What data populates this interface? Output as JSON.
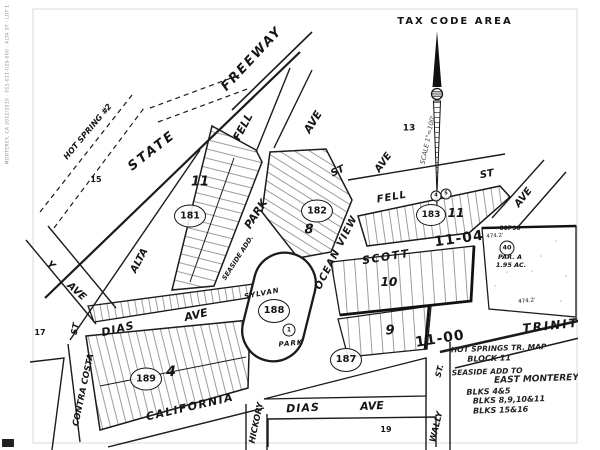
{
  "title": {
    "tax_code_area": "TAX CODE AREA",
    "scale_note": "SCALE 1\"=100'",
    "microprint": "MONTEREY, CA 2012/2019 · 011-021-025-000 · ALTA ST · LOT 1 · SHEET 1 OF 1"
  },
  "streets": {
    "state": "STATE",
    "freeway": "FREEWAY",
    "hot_spring": "HOT SPRING #2",
    "fell_ave": {
      "name": "FELL",
      "suffix": "AVE"
    },
    "fell_st": {
      "name": "FELL",
      "suffix": "ST"
    },
    "park_st": {
      "name": "PARK",
      "suffix": "ST"
    },
    "ocean_view": {
      "name": "OCEAN VIEW",
      "suffix": "AVE"
    },
    "scott": "SCOTT",
    "alta": "ALTA",
    "dias_upper": {
      "name": "DIAS",
      "suffix": "AVE"
    },
    "dias_lower": {
      "name": "DIAS",
      "suffix": "AVE"
    },
    "california": "CALIFORNIA",
    "trinity": "TRINITY",
    "contra_costa": {
      "name": "CONTRA COSTA",
      "suffix": "ST"
    },
    "hickory": "HICKORY",
    "wally": {
      "name": "WALLY",
      "suffix": "ST."
    },
    "y_ave": {
      "name": "Y",
      "suffix": "AVE"
    },
    "ave_right": "AVE"
  },
  "blocks": {
    "b181": {
      "circled": "181",
      "block_no": "11"
    },
    "b182": {
      "circled": "182",
      "block_no": "8"
    },
    "b183": {
      "circled": "183",
      "block_no": "11",
      "lot_a": "4",
      "lot_b": "5"
    },
    "b187": {
      "circled": "187"
    },
    "b188": {
      "circled": "188",
      "lot": "1",
      "park_name": "SYLVAN",
      "park_word": "PARK"
    },
    "b189": {
      "circled": "189",
      "block_no": "4"
    },
    "b10": "10",
    "b9": "9"
  },
  "areas": {
    "a13": "13",
    "a15": "15",
    "a17": "17",
    "a19": "19"
  },
  "codes": {
    "upper": "11-04",
    "lower": "11-00"
  },
  "parcel_a": {
    "ref": "80P90",
    "dim_top": "474.2'",
    "circled": "40",
    "name": "PAR. A",
    "acreage": "1.95 AC.",
    "dim_bottom": "474.2'"
  },
  "notes": {
    "seaside_add": "SEASIDE ADD."
  },
  "legend": {
    "lines": [
      "HOT SPRINGS TR. MAP",
      "BLOCK 11",
      "SEASIDE ADD TO",
      "EAST MONTEREY",
      "BLKS 4&5",
      "BLKS 8,9,10&11",
      "BLKS 15&16"
    ]
  }
}
